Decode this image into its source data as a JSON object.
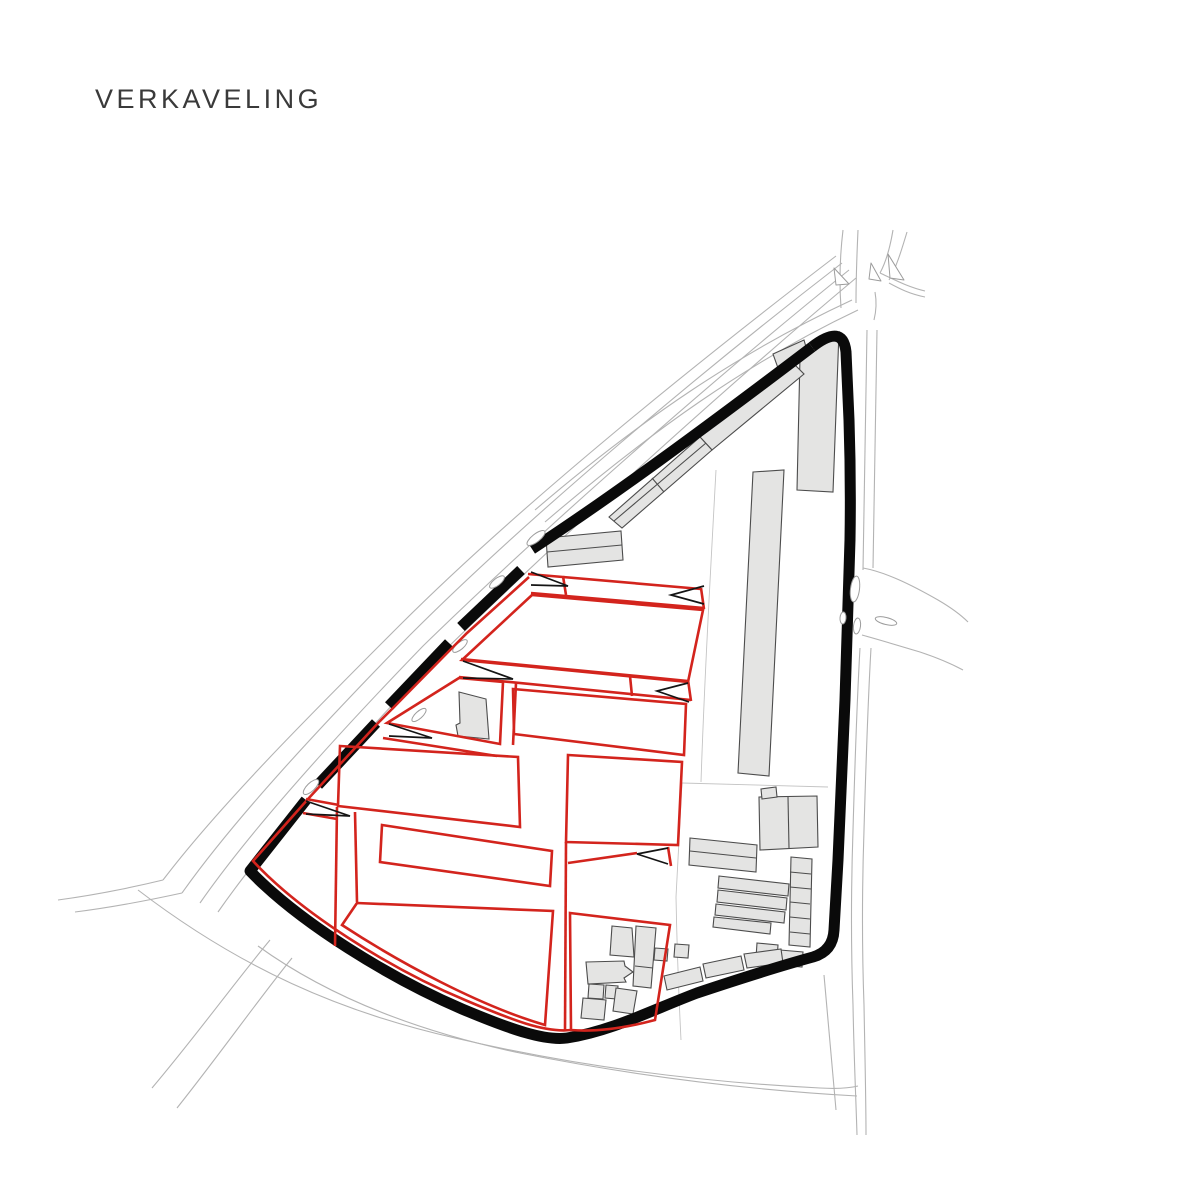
{
  "title": "VERKAVELING",
  "canvas": {
    "width": 1192,
    "height": 1192
  },
  "colors": {
    "background": "#ffffff",
    "title_text": "#3a3a3a",
    "road_line": "#b3b3b3",
    "thin_line": "#c4c4c4",
    "island_stroke": "#9c9c9c",
    "island_fill": "#ffffff",
    "building_fill": "#e4e4e3",
    "building_stroke": "#4c4c4c",
    "site_boundary": "#0a0a0a",
    "parcel_red": "#d3241d",
    "arrow_black": "#141414"
  },
  "strokes": {
    "road": 1.1,
    "thin": 0.9,
    "island": 1,
    "building": 1.1,
    "boundary": 11,
    "parcel": 2.6,
    "arrow": 1.7
  },
  "map": {
    "roads": [
      {
        "d": "M 836,256 C 700,360 520,505 400,625 C 310,715 220,805 163,880"
      },
      {
        "d": "M 842,263 C 706,368 530,515 410,635 C 322,725 235,818 182,893"
      },
      {
        "d": "M 849,270 C 716,377 545,527 423,646 C 335,737 250,831 200,903"
      },
      {
        "d": "M 856,278 C 726,387 558,539 437,658 C 350,748 266,843 218,912"
      },
      {
        "d": "M 852,300 C 740,352 640,420 535,510"
      },
      {
        "d": "M 858,310 C 748,362 650,432 545,522"
      },
      {
        "d": "M 841,308 C 839,280 840,255 843,230"
      },
      {
        "d": "M 856,303 C 856,275 857,252 858,230"
      },
      {
        "d": "M 893,230 C 890,248 886,262 880,273"
      },
      {
        "d": "M 907,232 C 901,252 896,268 889,280"
      },
      {
        "d": "M 880,273 C 895,280 908,287 925,291"
      },
      {
        "d": "M 889,283 C 900,289 910,294 925,297"
      },
      {
        "d": "M 875,292 C 877,303 876,312 874,320"
      },
      {
        "d": "M 867,330 L 863,570"
      },
      {
        "d": "M 877,330 L 873,568"
      },
      {
        "d": "M 863,568 C 885,572 910,584 938,600 C 950,607 960,614 968,622"
      },
      {
        "d": "M 862,635 C 880,640 900,646 920,652 C 935,657 950,663 963,670"
      },
      {
        "d": "M 860,648 C 857,700 855,760 853,830 C 851,890 851,950 853,1005 C 854,1060 856,1100 857,1135"
      },
      {
        "d": "M 871,648 C 868,700 866,760 864,830 C 862,890 862,950 864,1005 C 865,1060 866,1100 866,1135"
      },
      {
        "d": "M 138,890 C 240,968 340,1012 455,1038 C 575,1066 700,1082 820,1088 C 838,1089 850,1088 858,1086"
      },
      {
        "d": "M 258,946 C 330,998 420,1032 520,1053 C 640,1077 750,1090 857,1096"
      },
      {
        "d": "M 270,940 C 235,982 196,1036 152,1088"
      },
      {
        "d": "M 292,958 C 258,1000 220,1054 177,1108"
      },
      {
        "d": "M 163,880 C 130,888 95,895 58,900"
      },
      {
        "d": "M 182,893 C 150,900 115,907 75,912"
      },
      {
        "d": "M 824,975 C 828,1020 832,1065 836,1110"
      }
    ],
    "thin_lines": [
      {
        "d": "M 716,470 C 710,580 704,690 701,782"
      },
      {
        "d": "M 682,783 L 676,897 C 677,950 679,1000 681,1040"
      },
      {
        "d": "M 682,783 L 828,787"
      }
    ],
    "islands": [
      {
        "cx": 536,
        "cy": 538,
        "rx": 11,
        "ry": 4,
        "rot": -38
      },
      {
        "cx": 497,
        "cy": 582,
        "rx": 9,
        "ry": 3.5,
        "rot": -38
      },
      {
        "cx": 460,
        "cy": 646,
        "rx": 9,
        "ry": 3.5,
        "rot": -40
      },
      {
        "cx": 419,
        "cy": 715,
        "rx": 9,
        "ry": 3.5,
        "rot": -42
      },
      {
        "cx": 311,
        "cy": 787,
        "rx": 10,
        "ry": 4,
        "rot": -44
      },
      {
        "cx": 855,
        "cy": 589,
        "rx": 4.5,
        "ry": 13,
        "rot": 7
      },
      {
        "cx": 857,
        "cy": 626,
        "rx": 3.5,
        "ry": 8,
        "rot": 7
      },
      {
        "cx": 843,
        "cy": 618,
        "rx": 3,
        "ry": 6,
        "rot": 4
      },
      {
        "cx": 886,
        "cy": 621,
        "rx": 11,
        "ry": 3.5,
        "rot": 14
      }
    ],
    "island_triangles": [
      {
        "pts": "834,268 849,284 836,285"
      },
      {
        "pts": "871,263 881,281 869,279"
      },
      {
        "pts": "888,254 904,280 890,278"
      }
    ],
    "buildings": [
      {
        "d": "M 800,357 L 814,348 L 839,332 L 833,492 L 797,490 Z"
      },
      {
        "d": "M 773,354 L 804,340 L 808,354 L 778,368 Z"
      },
      {
        "d": "M 700,437 L 793,363 L 804,374 L 712,450 Z"
      },
      {
        "d": "M 609,517 L 700,437 L 712,450 L 622,528 Z"
      },
      {
        "d": "M 546,538 L 621,531 L 623,560 L 548,567 Z"
      },
      {
        "d": "M 459,692 L 486,699 L 489,739 L 458,736 L 456,725 L 460,723 Z"
      },
      {
        "d": "M 753,472 L 784,470 L 769,776 L 738,773 Z"
      },
      {
        "d": "M 759,797 L 817,796 L 818,847 L 760,850 Z"
      },
      {
        "d": "M 761,789 L 776,787 L 777,797 L 762,799 Z"
      },
      {
        "d": "M 690,838 L 757,845 L 756,872 L 689,865 Z"
      },
      {
        "d": "M 719,876 L 789,884 L 788,896 L 718,888 Z"
      },
      {
        "d": "M 718,890 L 787,898 L 786,910 L 717,902 Z"
      },
      {
        "d": "M 716,904 L 785,912 L 784,923 L 715,915 Z"
      },
      {
        "d": "M 714,917 L 771,923 L 770,934 L 713,927 Z"
      },
      {
        "d": "M 791,857 L 812,859 L 810,947 L 789,945 Z"
      },
      {
        "d": "M 780,950 L 803,952 L 802,967 L 779,965 Z"
      },
      {
        "d": "M 757,943 L 778,945 L 777,960 L 756,958 Z"
      },
      {
        "d": "M 664,976 L 700,967 L 703,981 L 667,990 Z"
      },
      {
        "d": "M 703,964 L 741,956 L 744,970 L 706,978 Z"
      },
      {
        "d": "M 744,954 L 781,949 L 783,963 L 747,968 Z"
      },
      {
        "d": "M 655,948 L 668,949 L 667,961 L 654,960 Z"
      },
      {
        "d": "M 675,944 L 689,945 L 688,958 L 674,957 Z"
      },
      {
        "d": "M 612,926 L 632,928 L 634,957 L 610,955 Z"
      },
      {
        "d": "M 586,962 L 624,961 L 625,966 L 633,972 L 624,978 L 626,982 L 588,984 Z"
      },
      {
        "d": "M 589,984 L 604,985 L 603,999 L 588,998 Z"
      },
      {
        "d": "M 606,985 L 618,986 L 617,999 L 605,998 Z"
      },
      {
        "d": "M 636,926 L 656,928 L 651,988 L 633,986 Z"
      },
      {
        "d": "M 616,988 L 637,991 L 633,1014 L 613,1011 Z"
      },
      {
        "d": "M 583,998 L 606,1000 L 604,1020 L 581,1018 Z"
      }
    ],
    "building_lines": [
      {
        "d": "M 652,478 L 664,492"
      },
      {
        "d": "M 614,521 L 706,443"
      },
      {
        "d": "M 547,552 L 622,545"
      },
      {
        "d": "M 788,797 L 789,848"
      },
      {
        "d": "M 690,851 L 756,858"
      },
      {
        "d": "M 790,872 L 811,874"
      },
      {
        "d": "M 790,887 L 811,889"
      },
      {
        "d": "M 790,902 L 810,904"
      },
      {
        "d": "M 790,917 L 810,919"
      },
      {
        "d": "M 790,932 L 810,934"
      },
      {
        "d": "M 635,966 L 653,968"
      }
    ],
    "boundary_segments": [
      {
        "d": "M 812,347 Q 843,323 846,352 L 849,420 Q 851,480 850,540 L 845,700 L 838,860 L 834,930 Q 833,951 813,957 C 780,966 742,978 697,993 C 652,1010 612,1031 567,1038 C 545,1041 512,1030 462,1009 C 390,978 300,923 250,871 L 306,800"
      },
      {
        "d": "M 318,785 L 376,723"
      },
      {
        "d": "M 389,706 L 449,643"
      },
      {
        "d": "M 461,627 L 521,570"
      },
      {
        "d": "M 532,549 C 610,498 700,432 812,347"
      }
    ],
    "parcels": [
      {
        "d": "M 529,577 L 467,633 L 454,646 L 391,710 L 379,722 L 308,799 L 253,861 C 300,912 390,969 465,1000 C 512,1020 545,1033 571,1030"
      },
      {
        "d": "M 528,574 L 701,589"
      },
      {
        "d": "M 531,593 L 704,608"
      },
      {
        "d": "M 701,588 L 704,609"
      },
      {
        "d": "M 563,576 L 566,595"
      },
      {
        "d": "M 532,595 L 703,610 L 688,682 L 462,660 Z"
      },
      {
        "d": "M 461,659 L 688,681"
      },
      {
        "d": "M 459,677 L 691,700"
      },
      {
        "d": "M 688,680 L 691,701"
      },
      {
        "d": "M 630,676 L 632,696"
      },
      {
        "d": "M 459,678 L 503,682 L 500,744 L 387,723 Z"
      },
      {
        "d": "M 383,738 L 497,756"
      },
      {
        "d": "M 516,683 L 513,745"
      },
      {
        "d": "M 513,689 L 686,704 L 684,755 L 514,734 Z"
      },
      {
        "d": "M 340,746 L 518,757 L 520,827 L 338,806 Z"
      },
      {
        "d": "M 382,825 L 552,851 L 550,886 L 380,862 Z"
      },
      {
        "d": "M 357,903 L 553,911 L 545,1025 C 480,1006 400,963 342,925 Z"
      },
      {
        "d": "M 568,755 L 682,762 L 678,845 L 566,842 Z"
      },
      {
        "d": "M 566,842 L 565,1031"
      },
      {
        "d": "M 568,863 L 637,853"
      },
      {
        "d": "M 668,847 L 671,866"
      },
      {
        "d": "M 570,913 L 670,925 L 655,1020 C 625,1028 595,1032 571,1030 Z"
      },
      {
        "d": "M 306,799 L 339,805"
      },
      {
        "d": "M 303,813 L 337,819"
      },
      {
        "d": "M 337,807 L 335,946"
      },
      {
        "d": "M 355,812 L 357,902"
      }
    ],
    "arrows": [
      {
        "d": "M 531,572 L 568,586 L 531,585"
      },
      {
        "d": "M 704,586 L 671,595 L 704,604"
      },
      {
        "d": "M 463,661 L 513,679 L 463,678"
      },
      {
        "d": "M 688,683 L 657,691 L 689,702"
      },
      {
        "d": "M 389,724 L 432,738 L 389,736"
      },
      {
        "d": "M 306,801 L 350,816 L 306,814"
      },
      {
        "d": "M 668,848 L 637,854 L 668,864"
      }
    ]
  }
}
